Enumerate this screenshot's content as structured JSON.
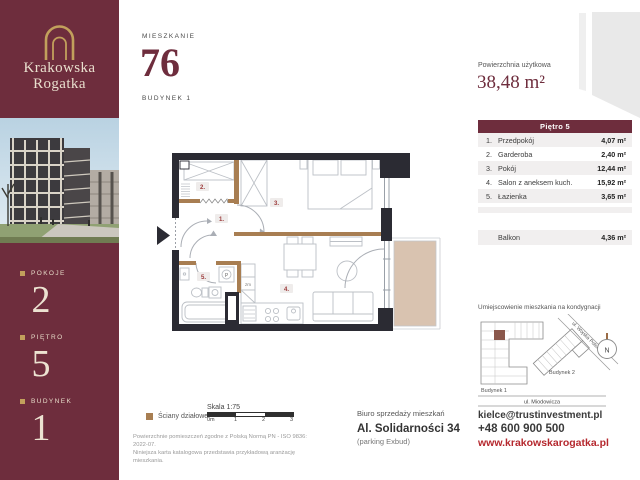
{
  "brand": {
    "line1": "Krakowska",
    "line2": "Rogatka"
  },
  "sidebar": {
    "stats": [
      {
        "label": "POKOJE",
        "value": "2"
      },
      {
        "label": "PIĘTRO",
        "value": "5"
      },
      {
        "label": "BUDYNEK",
        "value": "1"
      }
    ]
  },
  "header": {
    "kicker": "MIESZKANIE",
    "unit_number": "76",
    "building": "BUDYNEK 1"
  },
  "area": {
    "label": "Powierzchnia użytkowa",
    "value": "38,48 m²"
  },
  "rooms": {
    "header": "Piętro 5",
    "items": [
      {
        "no": "1.",
        "name": "Przedpokój",
        "area": "4,07 m²"
      },
      {
        "no": "2.",
        "name": "Garderoba",
        "area": "2,40 m²"
      },
      {
        "no": "3.",
        "name": "Pokój",
        "area": "12,44 m²"
      },
      {
        "no": "4.",
        "name": "Salon z aneksem kuch.",
        "area": "15,92 m²"
      },
      {
        "no": "5.",
        "name": "Łazienka",
        "area": "3,65 m²"
      }
    ],
    "balcony": {
      "name": "Balkon",
      "area": "4,36 m²"
    }
  },
  "plan": {
    "labels": {
      "r1": "1.",
      "r2": "2.",
      "r3": "3.",
      "r4": "4.",
      "r5": "5."
    },
    "washer_symbol": "P",
    "dishwasher_label": "zm"
  },
  "legend": {
    "walls_label": "Ściany działowe",
    "scale_label": "Skala 1:75",
    "ticks": [
      "0m",
      "1",
      "2",
      "3"
    ],
    "disclaimer_line1": "Powierzchnie pomieszczeń zgodne z Polską Normą PN - ISO 9836: 2022-07.",
    "disclaimer_line2": "Niniejsza karta katalogowa przedstawia przykładową aranżację mieszkania."
  },
  "office": {
    "title": "Biuro sprzedaży mieszkań",
    "address": "Al. Solidarności 34",
    "parking": "(parking  Exbud)"
  },
  "map": {
    "title": "Umiejscowienie mieszkania na kondygnacji",
    "building1": "Budynek 1",
    "building2": "Budynek 2",
    "street_diagonal": "ul. Wojska Polskiego",
    "street_horizontal": "ul. Miodowicza",
    "compass": "N"
  },
  "contact": {
    "email": "kielce@trustinvestment.pl",
    "phone": "+48 600 900 500",
    "website": "www.krakowskarogatka.pl"
  },
  "colors": {
    "maroon": "#6e2d3d",
    "gold": "#c2a05c",
    "cream": "#ece2d1",
    "wall_black": "#2b2b33",
    "partition_brown": "#a87e52",
    "balcony_tan": "#d9c3b0",
    "row_gray": "#f1efef",
    "link_red": "#b5282e"
  }
}
